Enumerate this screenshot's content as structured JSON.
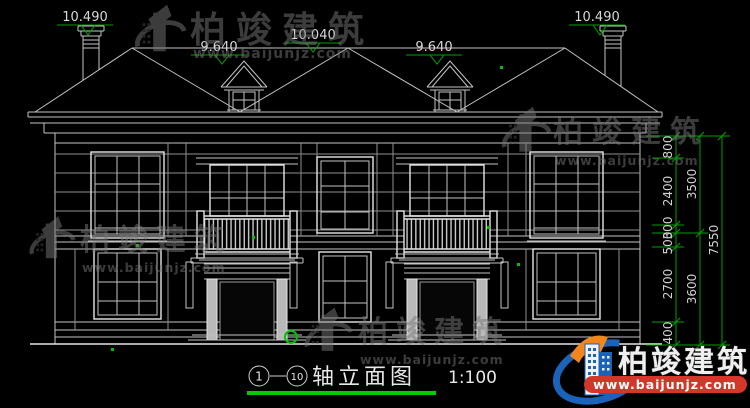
{
  "markers": {
    "left_chimney": "10.490",
    "left_dormer": "9.640",
    "ridge": "10.040",
    "right_dormer": "9.640",
    "right_chimney": "10.490"
  },
  "dims": {
    "inner": [
      "800",
      "2400",
      "300",
      "500",
      "2700",
      "400"
    ],
    "middle": [
      "3500",
      "3600"
    ],
    "outer": [
      "7550"
    ]
  },
  "title": {
    "axis_from": "1",
    "axis_to": "10",
    "name": "轴立面图",
    "scale": "1:100"
  },
  "watermark": {
    "brand": "柏竣建筑",
    "url": "www.baijunjz.com"
  },
  "logo": {
    "brand": "柏竣建筑",
    "url": "www.baijunjz.com"
  },
  "colors": {
    "background": "#000000",
    "cad_line": "#c4c4c4",
    "dimension_green": "#00a000",
    "underline_green": "#00cc00",
    "logo_blue": "#1a63b8",
    "logo_orange": "#f0861c",
    "banner_red": "#d23729"
  }
}
